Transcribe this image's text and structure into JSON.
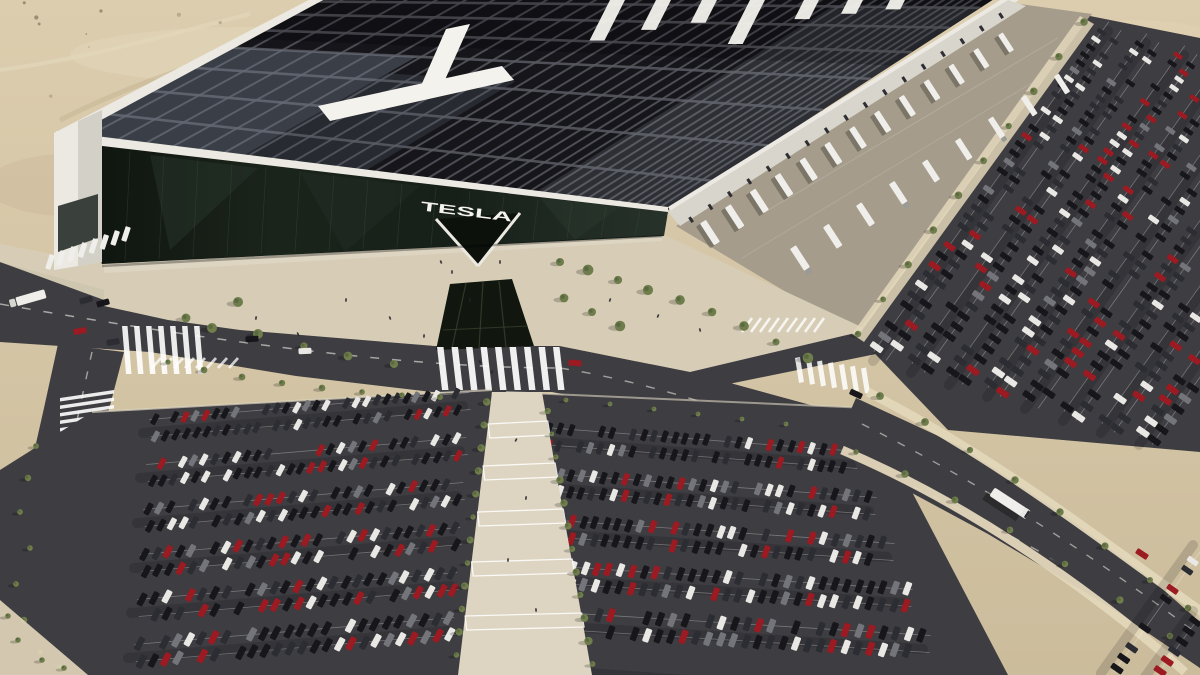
{
  "scene": {
    "title": "Aerial rendering of a Tesla Gigafactory in the desert with a solar roof and full parking lots",
    "setting": "desert, daytime, long shadows to the lower-left",
    "facade_sign": "TESLA",
    "roof_letters": "TESLA",
    "roof_letters_note": "giant white solar-panel letters on the dark roof; the T is fully visible, the other letters are cut off by the top edge",
    "seed": 42,
    "palette": {
      "sand": "#d5c6a6",
      "sandLight": "#e3d7bb",
      "sandShadow": "#c2b191",
      "asphalt": "#3e3d41",
      "roadLine": "#f0eee6",
      "roofDark": "#15151a",
      "roofGrid": "#5b5b63",
      "roofGlare": "#76808e",
      "parapet": "#ebe9e2",
      "sideWall": "#d8d5cc",
      "apron": "#a59c8b",
      "plaza": "#d7cdb6",
      "walkway": "#ddd5c1",
      "skylight": "#11170f",
      "treeGreen": "#6e7d4b",
      "treeDark": "#4f5c38",
      "carBlack": "#17171b",
      "carDark": "#2c2d33",
      "carGray": "#73757a",
      "carWhite": "#e9e8e4",
      "carRed": "#9c1a21",
      "truckWhite": "#efeeea",
      "shadow": "rgba(0,0,0,0.30)"
    },
    "building": {
      "roof": "dark photovoltaic panel grid with gray maintenance walkways and diagonal sun glare",
      "facade": "dark reflective glass with white TESLA lettering above a V-shaped entrance",
      "left_end_wall": "white",
      "dock_side": "loading docks along the north-east wall"
    },
    "vehicles": {
      "car_color_weights": {
        "black": 0.4,
        "dark_gray": 0.22,
        "white": 0.16,
        "red": 0.13,
        "silver": 0.09
      },
      "approx_parked_cars": 850,
      "docked_trailers": 22,
      "semi_truck_on_road": 1,
      "box_truck_on_west_road": 1
    },
    "landscaping": {
      "trees_and_shrubs": "desert landscaping along plaza, walkways and road medians"
    }
  }
}
